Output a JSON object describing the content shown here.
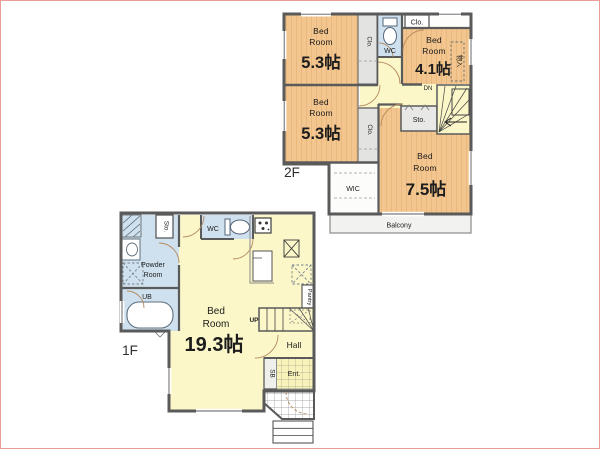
{
  "colors": {
    "wall": "#5a5a5a",
    "wood_floor": "#f3c68f",
    "wood_stripe": "#dfa96b",
    "hall_yellow": "#fbf7c8",
    "water_blue": "#cfe1ef",
    "closet_grey": "#e3e3e1",
    "balcony_grey": "#f2f2f0",
    "door_arc": "#b58a5f",
    "frame_border": "#ec9b9b"
  },
  "f2": {
    "floor_label": "2F",
    "bedroom_a": {
      "l1": "Bed",
      "l2": "Room",
      "size": "5.3帖"
    },
    "bedroom_b": {
      "l1": "Bed",
      "l2": "Room",
      "size": "5.3帖"
    },
    "bedroom_c": {
      "l1": "Bed",
      "l2": "Room",
      "size": "4.1帖"
    },
    "bedroom_d": {
      "l1": "Bed",
      "l2": "Room",
      "size": "7.5帖"
    },
    "wc": "WC",
    "sto": "Sto.",
    "wic": "WIC",
    "balcony": "Balcony",
    "closet_a": "Clo.",
    "closet_b": "Clo.",
    "closet_top": "Clo.",
    "closet_kanji": "物入",
    "down": "DN"
  },
  "f1": {
    "floor_label": "1F",
    "bedroom": {
      "l1": "Bed",
      "l2": "Room",
      "size": "19.3帖"
    },
    "wc": "WC",
    "sto": "Sto.",
    "powder_l1": "Powder",
    "powder_l2": "Room",
    "ub": "UB",
    "hall": "Hall",
    "entrance": "Ent.",
    "shoe_box": "SB",
    "pantry": "Pantry",
    "up": "UP"
  }
}
